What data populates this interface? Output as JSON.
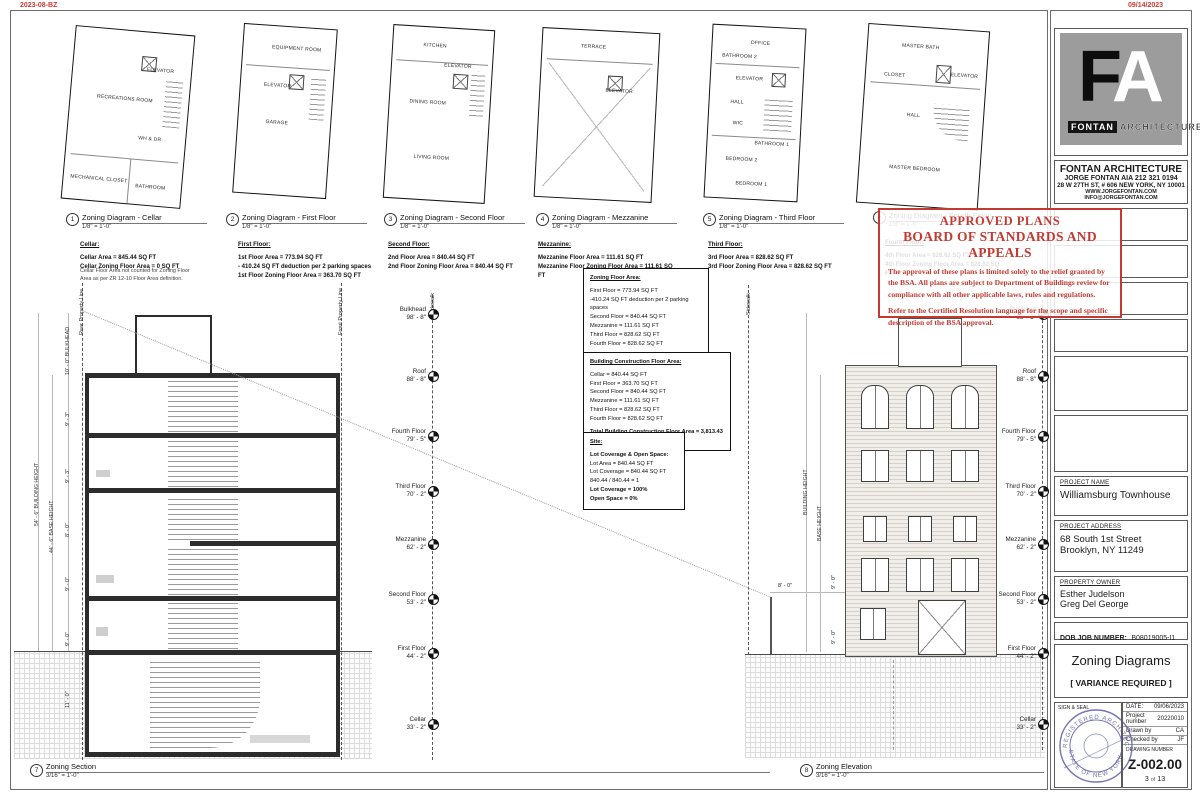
{
  "corner": {
    "top_left": "2023-08-BZ",
    "top_right": "09/14/2023"
  },
  "views": {
    "v1": {
      "num": "1",
      "title": "Zoning Diagram - Cellar",
      "scale": "1/8\" = 1'-0\""
    },
    "v2": {
      "num": "2",
      "title": "Zoning Diagram - First Floor",
      "scale": "1/8\" = 1'-0\""
    },
    "v3": {
      "num": "3",
      "title": "Zoning Diagram - Second Floor",
      "scale": "1/8\" = 1'-0\""
    },
    "v4": {
      "num": "4",
      "title": "Zoning Diagram - Mezzanine",
      "scale": "1/8\" = 1'-0\""
    },
    "v5": {
      "num": "5",
      "title": "Zoning Diagram - Third Floor",
      "scale": "1/8\" = 1'-0\""
    },
    "v6": {
      "num": "6",
      "title": "Zoning Diagram - Fourth Floor",
      "scale": "1/8\" = 1'-0\""
    },
    "v7": {
      "num": "7",
      "title": "Zoning Section",
      "scale": "3/16\" = 1'-0\""
    },
    "v8": {
      "num": "8",
      "title": "Zoning Elevation",
      "scale": "3/16\" = 1'-0\""
    }
  },
  "notes": {
    "cellar": {
      "heading": "Cellar:",
      "l1": "Cellar Area = 845.44 SQ FT",
      "l2": "Cellar Zoning Floor Area = 0 SQ FT",
      "note": "Cellar Floor Area not counted for Zoning Floor Area as per ZR 12-10 Floor Area definition."
    },
    "first": {
      "heading": "First Floor:",
      "l1": "1st Floor Area = 773.94 SQ FT",
      "l2": "- 410.24 SQ FT deduction per 2 parking spaces",
      "l3": "1st Floor Zoning Floor Area = 363.70 SQ FT"
    },
    "second": {
      "heading": "Second Floor:",
      "l1": "2nd Floor Area = 840.44 SQ FT",
      "l2": "2nd Floor Zoning Floor Area = 840.44 SQ FT"
    },
    "mezz": {
      "heading": "Mezzanine:",
      "l1": "Mezzanine Floor Area = 111.61 SQ FT",
      "l2": "Mezzanine Floor Zoning Floor Area = 111.61 SQ FT"
    },
    "third": {
      "heading": "Third Floor:",
      "l1": "3rd Floor Area = 828.62 SQ FT",
      "l2": "3rd Floor Zoning Floor Area = 828.62 SQ FT"
    },
    "fourth": {
      "heading": "Fourth Floor:",
      "l1": "4th Floor Area = 828.62 SQ FT",
      "l2": "4th Floor Zoning Floor Area = 828.62 SQ FT"
    }
  },
  "rooms": {
    "cellar": [
      "RECREATIONS ROOM",
      "ELEVATOR",
      "WH & DR",
      "MECHANICAL CLOSET",
      "BATHROOM"
    ],
    "first": [
      "EQUIPMENT ROOM",
      "ELEVATOR",
      "GARAGE"
    ],
    "second": [
      "KITCHEN",
      "ELEVATOR",
      "DINING ROOM",
      "LIVING ROOM"
    ],
    "mezz": [
      "TERRACE",
      "ELEVATOR"
    ],
    "third": [
      "OFFICE",
      "ELEVATOR",
      "HALL",
      "BATHROOM 2",
      "WIC",
      "BATHROOM 1",
      "BEDROOM 2",
      "BEDROOM 1"
    ],
    "fourth": [
      "MASTER BATH",
      "CLOSET",
      "ELEVATOR",
      "HALL",
      "MASTER BEDROOM"
    ]
  },
  "summary": {
    "zfa": {
      "title": "Zoning Floor Area:",
      "lines": [
        "First Floor = 773.94 SQ FT",
        "-410.24 SQ FT deduction per 2 parking spaces",
        "Second Floor = 840.44 SQ FT",
        "Mezzanine = 111.61 SQ FT",
        "Third Floor = 828.62 SQ FT",
        "Fourth Floor = 828.62 SQ FT"
      ],
      "total": "Total Zoning Floor Area = 2,973 SF",
      "note": "CELLAR NOT COUNTED"
    },
    "bcfa": {
      "title": "Building Construction Floor Area:",
      "lines": [
        "Cellar = 840.44 SQ FT",
        "First Floor = 363.70 SQ FT",
        "Second Floor = 840.44 SQ FT",
        "Mezzanine = 111.61 SQ FT",
        "Third Floor = 828.62 SQ FT",
        "Fourth Floor = 828.62 SQ FT"
      ],
      "total": "Total Building Construction Floor Area = 3,813.43 SQ FT"
    },
    "site": {
      "title": "Site:",
      "subtitle": "Lot Coverage & Open Space:",
      "lines": [
        "Lot Area = 840.44 SQ FT",
        "Lot Coverage = 840.44 SQ FT",
        "840.44 / 840.44 = 1"
      ],
      "bold1": "Lot Coverage = 100%",
      "bold2": "Open Space = 0%"
    }
  },
  "stamp": {
    "line1": "APPROVED PLANS",
    "line2": "BOARD OF STANDARDS AND APPEALS",
    "para1": "The approval of these plans is limited solely to the relief granted by the BSA.  All plans are subject to Department of Buildings review for compliance with all other applicable laws, rules and regulations.",
    "para2": "Refer to the Certified Resolution language for the scope and specific description of the BSA approval."
  },
  "levels": [
    {
      "name": "Bulkhead",
      "elev": "98' - 8\""
    },
    {
      "name": "Roof",
      "elev": "88' - 8\""
    },
    {
      "name": "Fourth Floor",
      "elev": "79' - 5\""
    },
    {
      "name": "Third Floor",
      "elev": "70' - 2\""
    },
    {
      "name": "Mezzanine",
      "elev": "62' - 2\""
    },
    {
      "name": "Second Floor",
      "elev": "53' - 2\""
    },
    {
      "name": "First Floor",
      "elev": "44' - 2\""
    },
    {
      "name": "Cellar",
      "elev": "33' - 2\""
    }
  ],
  "section": {
    "rear_pl": "Rear Property Line",
    "front_pl": "Front Property Line",
    "sidewalk": "Sidewalk",
    "bulkhead_dim": "10' - 0\"  BULKHEAD",
    "dims": [
      "9' - 3\"",
      "9' - 3\"",
      "8' - 0\"",
      "9' - 0\"",
      "9' - 0\"",
      "11' - 0\""
    ],
    "building_height": "54' - 6\"  BUILDING HEIGHT",
    "base_height": "44' - 6\"  BASE HEIGHT"
  },
  "elevation": {
    "sidewalk": "Sidewalk",
    "building_height": "BUILDING HEIGHT",
    "base_height": "BASE HEIGHT",
    "dim8": "8' - 0\"",
    "dim9a": "9' - 0\"",
    "dim9b": "9' - 0\""
  },
  "titleblock": {
    "logo_f": "F",
    "logo_a": "A",
    "logo_bar_left": "FONTAN",
    "logo_bar_right": "ARCHITECTURE",
    "firm_name": "FONTAN ARCHITECTURE",
    "firm_line2": "JORGE FONTAN AIA 212 321 0194",
    "firm_line3": "28 W 27TH ST, # 606 NEW YORK, NY 10001",
    "firm_line4": "WWW.JORGEFONTAN.COM  INFO@JORGEFONTAN.COM",
    "project_name_label": "PROJECT NAME",
    "project_name": "Williamsburg Townhouse",
    "address_label": "PROJECT ADDRESS",
    "address1": "68 South 1st Street",
    "address2": "Brooklyn, NY 11249",
    "owner_label": "PROPERTY OWNER",
    "owner1": "Esther Judelson",
    "owner2": "Greg Del George",
    "dob_label": "DOB JOB NUMBER:",
    "dob_value": "B08019005-I1",
    "sheet_title": "Zoning Diagrams",
    "variance": "[ VARIANCE REQUIRED ]",
    "sign_seal_label": "SIGN & SEAL",
    "date_label": "DATE:",
    "date_value": "09/06/2023",
    "project_number_label": "Project number",
    "project_number": "20220010",
    "drawn_by_label": "Drawn by",
    "drawn_by": "CA",
    "checked_by_label": "Checked by",
    "checked_by": "JF",
    "drawing_number_label": "DRAWING NUMBER",
    "drawing_number": "Z-002.00",
    "page": "3",
    "of_label": "of",
    "pages": "13",
    "seal_top": "REGISTERED ARCHITECT",
    "seal_bottom": "STATE OF NEW YORK"
  }
}
